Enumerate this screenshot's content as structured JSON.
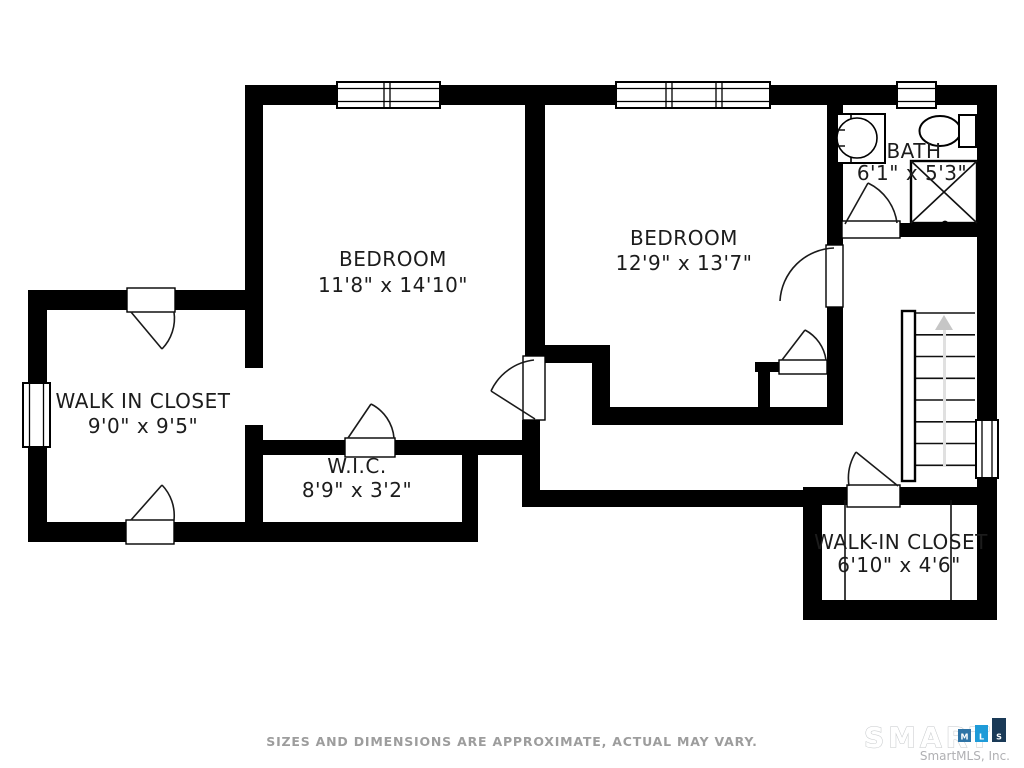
{
  "rooms": {
    "bedroom1": {
      "name": "BEDROOM",
      "dims": "11'8\" x 14'10\""
    },
    "bedroom2": {
      "name": "BEDROOM",
      "dims": "12'9\" x 13'7\""
    },
    "bath": {
      "name": "BATH",
      "dims": "6'1\" x 5'3\""
    },
    "closet_left": {
      "name": "WALK IN CLOSET",
      "dims": "9'0\" x 9'5\""
    },
    "wic": {
      "name": "W.I.C.",
      "dims": "8'9\" x 3'2\""
    },
    "closet_right": {
      "name": "WALK-IN CLOSET",
      "dims": "6'10\" x 4'6\""
    }
  },
  "footer": {
    "disclaimer": "SIZES AND DIMENSIONS ARE APPROXIMATE, ACTUAL MAY VARY."
  },
  "logo": {
    "brand": "SMART",
    "company": "SmartMLS, Inc.",
    "bars": {
      "m": {
        "letter": "M",
        "color": "#2f74a6"
      },
      "l": {
        "letter": "L",
        "color": "#1f9bd8"
      },
      "s": {
        "letter": "S",
        "color": "#1a3a57"
      }
    }
  },
  "colors": {
    "wall": "#000000",
    "label": "#1c1c1c",
    "muted": "#9d9d9d",
    "arrow": "#c6c6c6"
  }
}
